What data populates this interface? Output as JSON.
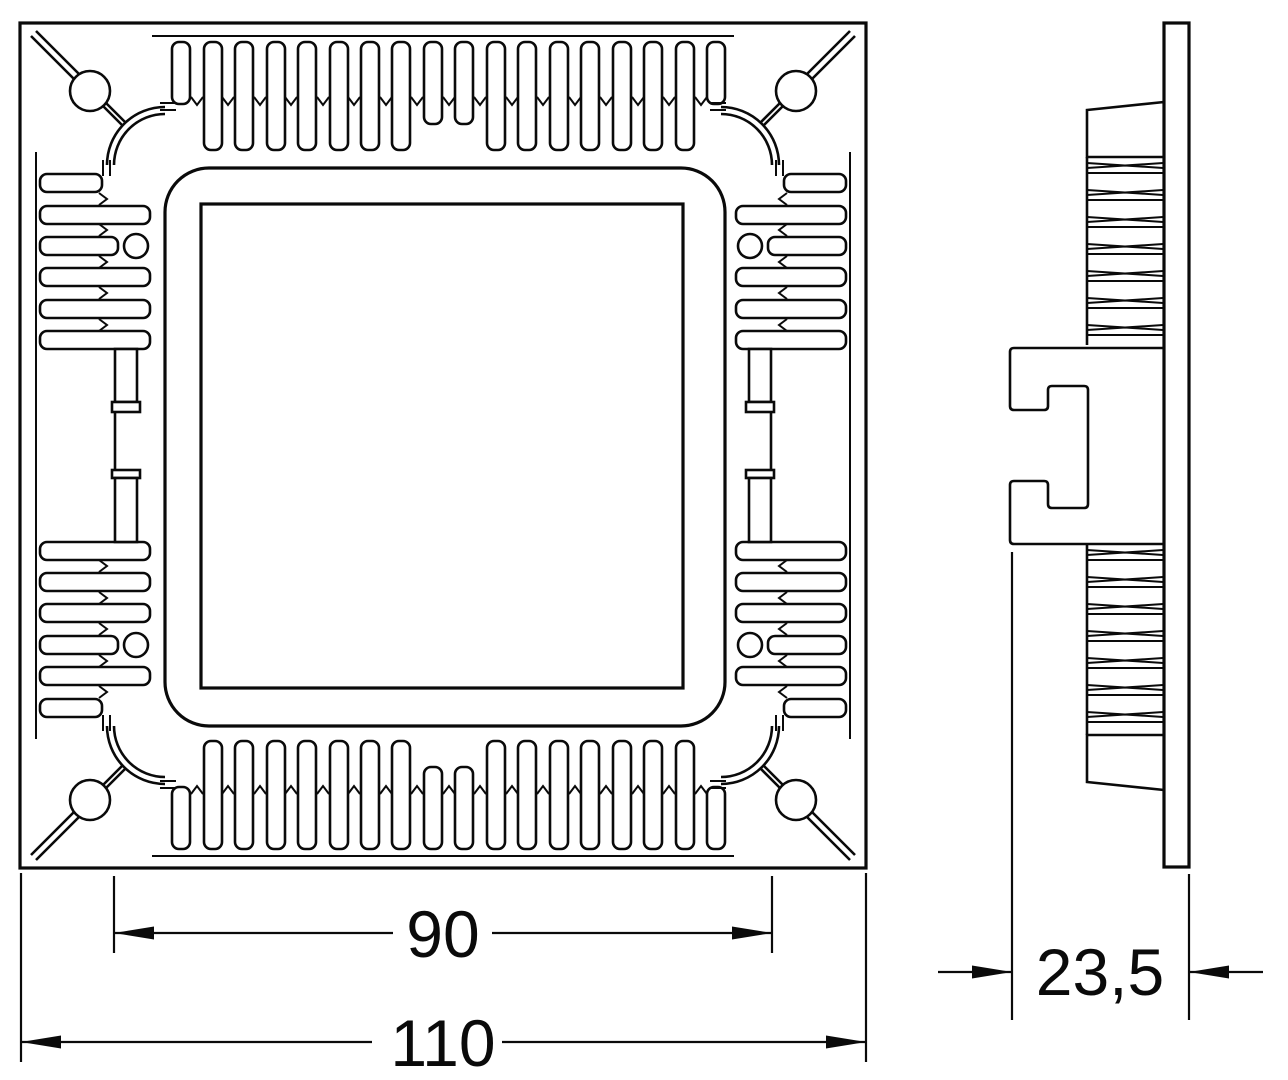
{
  "colors": {
    "background": "#ffffff",
    "line": "#0a0a0a"
  },
  "front_view": {
    "dimension_inner": {
      "label": "90"
    },
    "dimension_outer": {
      "label": "110"
    }
  },
  "side_view": {
    "dimension_depth": {
      "label": "23,5"
    }
  }
}
